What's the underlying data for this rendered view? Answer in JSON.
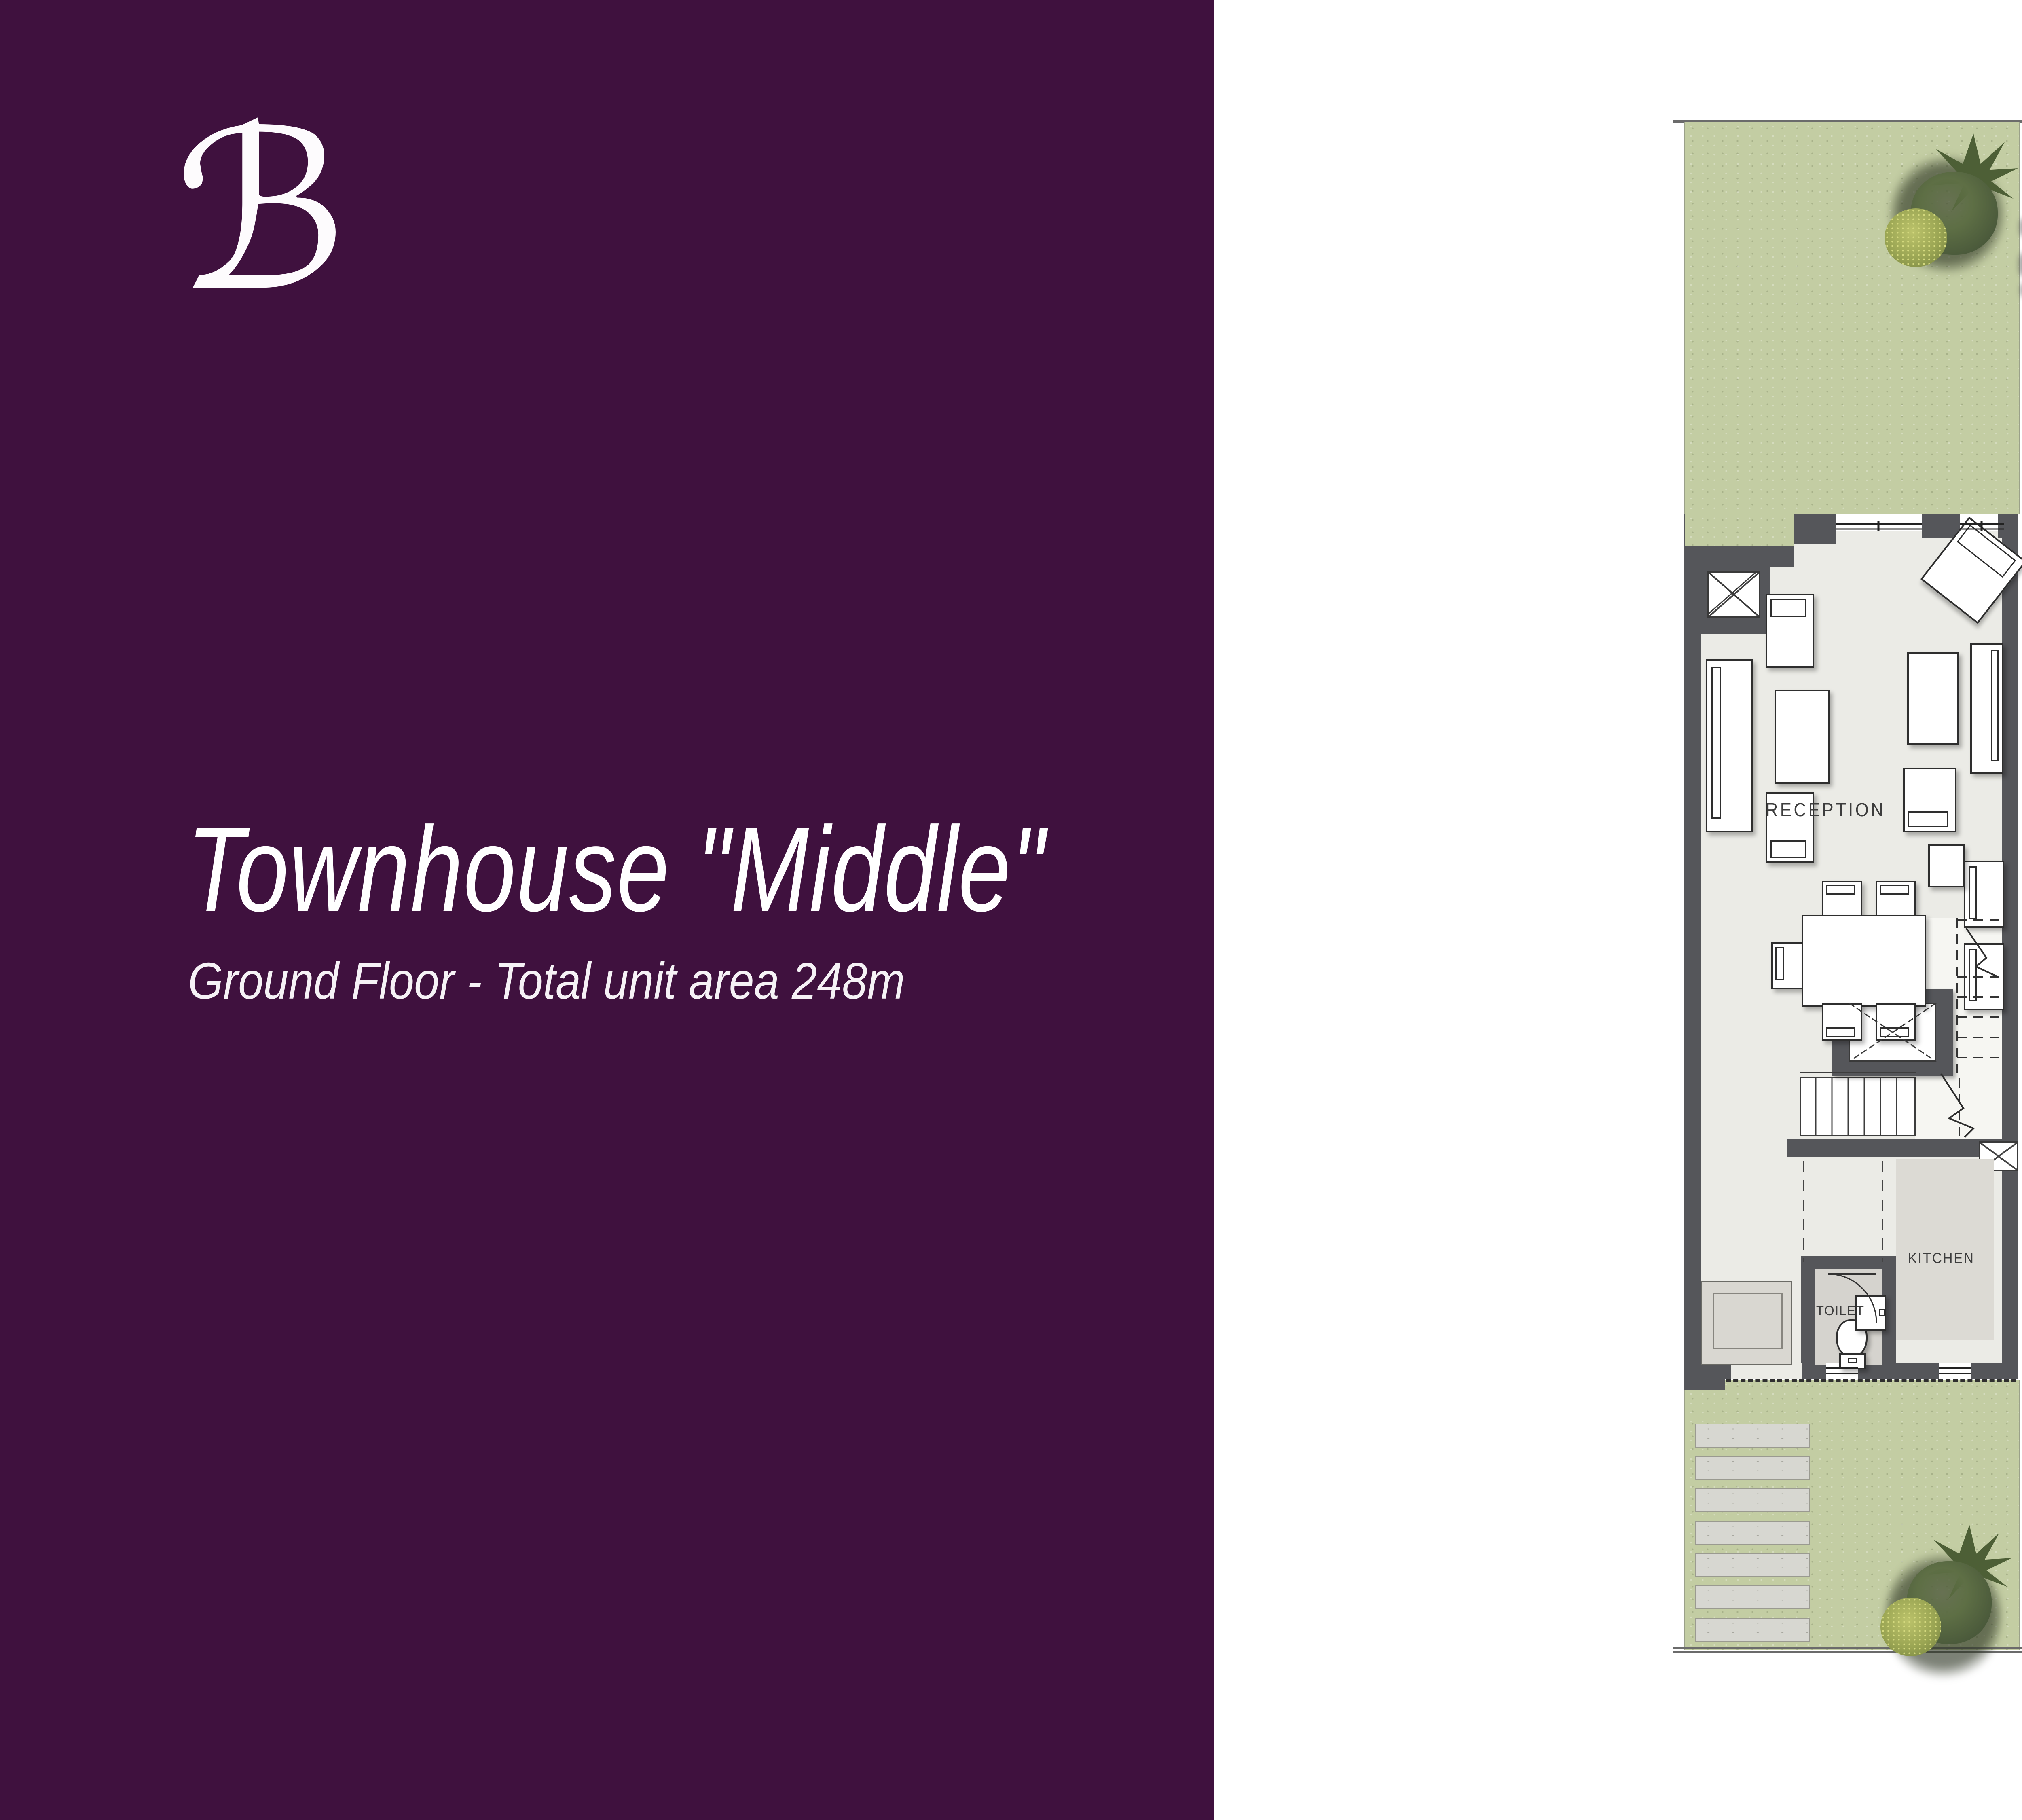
{
  "sidebar": {
    "logo_letter": "ℬ",
    "title": "Townhouse \"Middle\"",
    "subtitle": "Ground Floor - Total unit area 248m"
  },
  "plan": {
    "labels": {
      "reception": "RECEPTION",
      "kitchen": "KITCHEN",
      "toilet": "TOILET",
      "up": "UP"
    }
  },
  "room_table": {
    "headers": [
      "ROOM",
      "LENGTH",
      "WIDTH"
    ],
    "rows": [
      {
        "room": "RECEPTION",
        "length": "7.30",
        "width": "5.00"
      },
      {
        "room": "KITCHEN",
        "length": "3.20",
        "width": "2.00"
      },
      {
        "room": "TOILET",
        "length": "1.90",
        "width": "1.20"
      }
    ]
  },
  "area_table": {
    "rows": [
      {
        "label": "BUA",
        "value": "248"
      },
      {
        "label": "Open Roof",
        "value": "24.144"
      }
    ]
  },
  "site_plan": {
    "units_count": 6
  },
  "colors": {
    "sidebar_purple": "#3F113E",
    "lawn_green": "#C3CDA3",
    "wall_gray": "#55565A",
    "floor_beige": "#EBEBE6",
    "room_gray": "#D8D6D0",
    "paver_gray": "#D7D7D1"
  }
}
